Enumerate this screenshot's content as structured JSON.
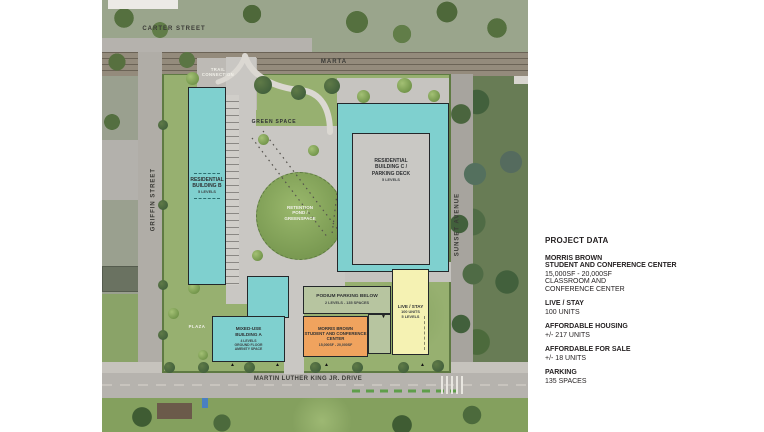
{
  "plan": {
    "streets": {
      "carter": "CARTER STREET",
      "marta": "MARTA",
      "griffin": "GRIFFIN STREET",
      "sunset": "SUNSET AVENUE",
      "mlk": "MARTIN LUTHER KING JR. DRIVE"
    },
    "areas": {
      "trail_connection": "TRAIL\nCONNECTION",
      "green_space": "GREEN SPACE",
      "retention_pond": "RETENTION\nPOND /\nGREENSPACE",
      "plaza": "PLAZA"
    },
    "buildings": {
      "residential_b": {
        "name": "RESIDENTIAL\nBUILDING B",
        "levels": "5 LEVELS"
      },
      "residential_c": {
        "name": "RESIDENTIAL\nBUILDING C /\nPARKING DECK",
        "levels": "5 LEVELS"
      },
      "podium_parking": {
        "name": "PODIUM PARKING BELOW",
        "details": "2 LEVELS - 135 SPACES"
      },
      "morris_brown": {
        "name": "MORRIS BROWN\nSTUDENT AND CONFERENCE\nCENTER",
        "details": "15,000SF - 20,000SF"
      },
      "live_stay": {
        "name": "LIVE / STAY",
        "details": "100 UNITS\n5 LEVELS"
      },
      "mixed_use_a": {
        "name": "MIXED-USE\nBUILDING A",
        "details": "4 LEVELS\nGROUND FLOOR\nAMENITY SPACE"
      }
    },
    "icons": {
      "triangle_up": "▲",
      "triangle_down": "▼"
    }
  },
  "project_data": {
    "title": "PROJECT DATA",
    "sections": [
      {
        "header": "MORRIS BROWN\nSTUDENT AND CONFERENCE CENTER",
        "body": "15,000SF - 20,000SF\nCLASSROOM AND\nCONFERENCE CENTER"
      },
      {
        "header": "LIVE / STAY",
        "body": "100 UNITS"
      },
      {
        "header": "AFFORDABLE HOUSING",
        "body": "+/- 217 UNITS"
      },
      {
        "header": "AFFORDABLE FOR SALE",
        "body": "+/- 18 UNITS"
      },
      {
        "header": "PARKING",
        "body": "135 SPACES"
      }
    ]
  },
  "colors": {
    "residential_teal": "#7fd0cf",
    "parking_deck_gray": "#c9c8c4",
    "conference_orange": "#f0a35e",
    "live_stay_yellow": "#f5f2b3",
    "podium_sage": "#b7c5a0",
    "site_green": "#97b070",
    "retention_green": "#84a45c"
  }
}
